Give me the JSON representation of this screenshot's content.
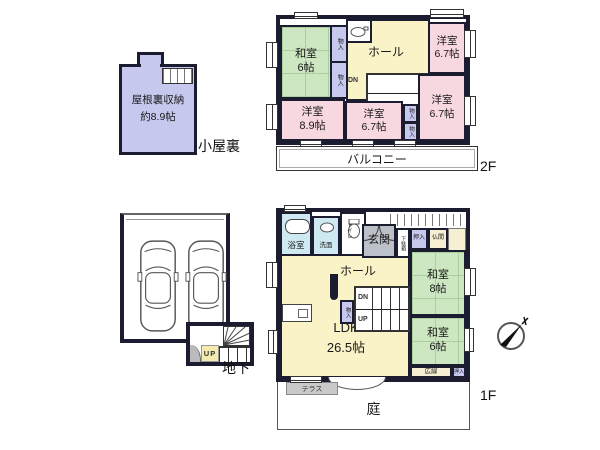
{
  "attic": {
    "floor_label": "小屋裏",
    "storage_name": "屋根裏収納",
    "storage_size": "約8.9帖"
  },
  "floor2": {
    "floor_label": "2F",
    "balcony_label": "バルコニー",
    "closet_label": "物入",
    "stairs_down_label": "DN",
    "rooms": {
      "washitsu": {
        "name": "和室",
        "size": "6帖"
      },
      "hall": {
        "name": "ホール"
      },
      "yoshitsu_top_right": {
        "name": "洋室",
        "size": "6.7帖"
      },
      "yoshitsu_left": {
        "name": "洋室",
        "size": "8.9帖"
      },
      "yoshitsu_center": {
        "name": "洋室",
        "size": "6.7帖"
      },
      "yoshitsu_right": {
        "name": "洋室",
        "size": "6.7帖"
      }
    }
  },
  "floor1": {
    "floor_label": "1F",
    "bath_label": "浴室",
    "washroom_label": "洗面",
    "toilet_label": "トイレ",
    "entrance_label": "玄関",
    "shoe_cabinet_label": "下駄箱",
    "closet_upper_label": "押入",
    "altar_label": "仏間",
    "hall_label": "ホール",
    "closet_label": "物入",
    "stairs_down_label": "DN",
    "stairs_up_label": "UP",
    "ldk": {
      "name": "LDK",
      "size": "26.5帖"
    },
    "washitsu8": {
      "name": "和室",
      "size": "8帖"
    },
    "washitsu6": {
      "name": "和室",
      "size": "6帖"
    },
    "veranda_label": "広縁",
    "closet_lower_label": "押入",
    "terrace_label": "テラス",
    "garden_label": "庭"
  },
  "basement": {
    "floor_label": "地下",
    "stairs_up_label": "UP"
  },
  "colors": {
    "wall": "#1c1c30",
    "pink": "#f7d7e0",
    "green": "#cde7c2",
    "tatami": "#a8cf9c",
    "yellow": "#faf3c8",
    "lav": "#c7c8ee",
    "blue": "#cfe9f2",
    "gray": "#bcc0c9",
    "cream": "#f6efd4",
    "terrace": "#c9c9c9"
  }
}
